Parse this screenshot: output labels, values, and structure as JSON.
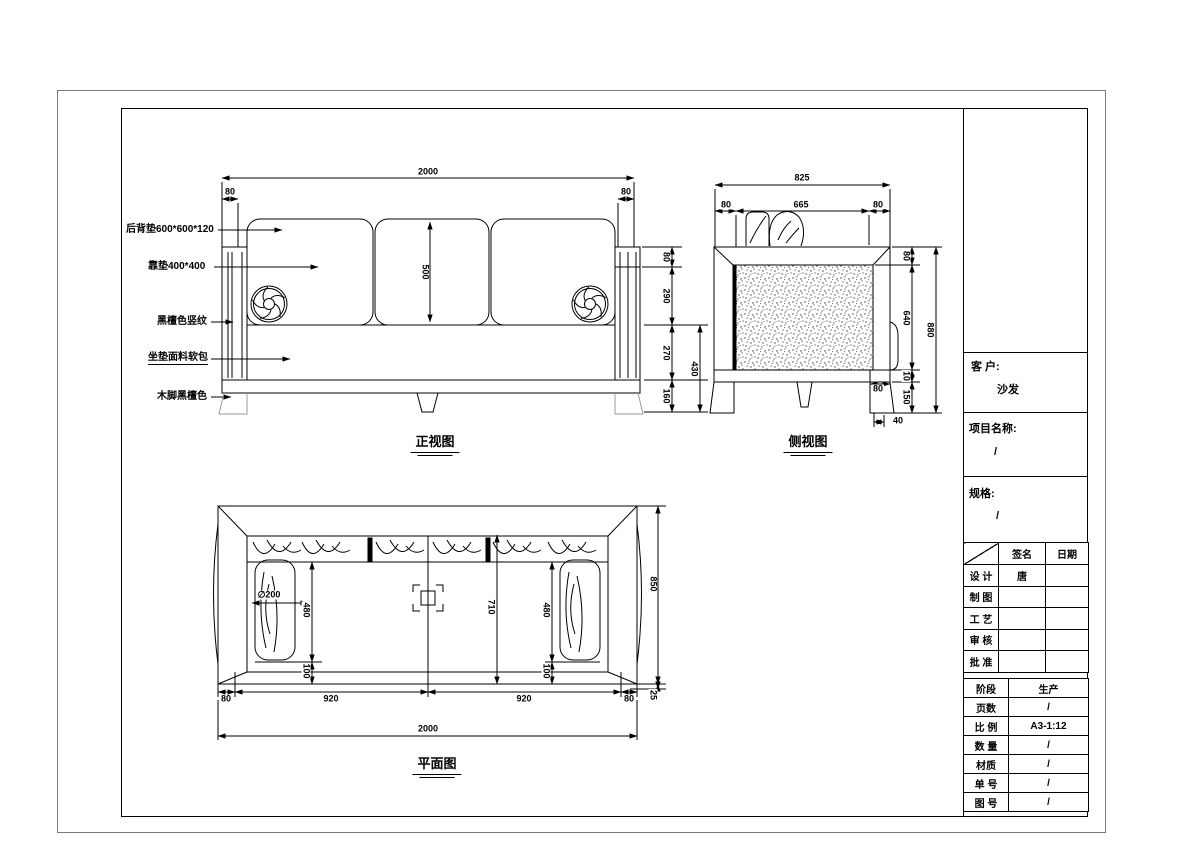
{
  "front_view": {
    "caption": "正视图",
    "part_labels": [
      "后背垫600*600*120",
      "靠垫400*400",
      "黑檀色竖纹",
      "坐垫面料软包",
      "木脚黑檀色"
    ],
    "dim_total_width": "2000",
    "dim_arm_left": "80",
    "dim_arm_right": "80",
    "dim_back_cushion": "500",
    "dim_top": "80",
    "dim_back": "290",
    "dim_seat": "270",
    "dim_leg": "160",
    "dim_seat_leg": "430"
  },
  "side_view": {
    "caption": "侧视图",
    "dim_total_width": "825",
    "dim_left": "80",
    "dim_inner": "665",
    "dim_right": "80",
    "dim_frame_top": "80",
    "dim_back_height": "640",
    "dim_gap": "10",
    "dim_leg": "150",
    "dim_total_height": "880",
    "dim_base": "80",
    "dim_leg_offset": "40"
  },
  "plan_view": {
    "caption": "平面图",
    "dim_diameter": "∅200",
    "dim_cushion_left": "480",
    "dim_gap_left": "100",
    "dim_depth_inner": "710",
    "dim_cushion_right": "480",
    "dim_gap_right": "100",
    "dim_total_depth": "850",
    "dim_front": "25",
    "dim_b_left": "80",
    "dim_b_seat_left": "920",
    "dim_b_seat_right": "920",
    "dim_b_right": "80",
    "dim_b_total": "2000"
  },
  "title_block": {
    "client_label": "客 户:",
    "client_value": "沙发",
    "project_label": "项目名称:",
    "project_value": "/",
    "spec_label": "规格:",
    "spec_value": "/",
    "sign_col": "签名",
    "date_col": "日期",
    "sign_rows": [
      {
        "label": "设 计",
        "sign": "唐",
        "date": ""
      },
      {
        "label": "制 图",
        "sign": "",
        "date": ""
      },
      {
        "label": "工 艺",
        "sign": "",
        "date": ""
      },
      {
        "label": "审 核",
        "sign": "",
        "date": ""
      },
      {
        "label": "批 准",
        "sign": "",
        "date": ""
      }
    ],
    "info_rows": [
      {
        "label": "阶段",
        "value": "生产"
      },
      {
        "label": "页数",
        "value": "/"
      },
      {
        "label": "比 例",
        "value": "A3-1:12"
      },
      {
        "label": "数 量",
        "value": "/"
      },
      {
        "label": "材质",
        "value": "/"
      },
      {
        "label": "单 号",
        "value": "/"
      },
      {
        "label": "图 号",
        "value": "/"
      }
    ]
  }
}
